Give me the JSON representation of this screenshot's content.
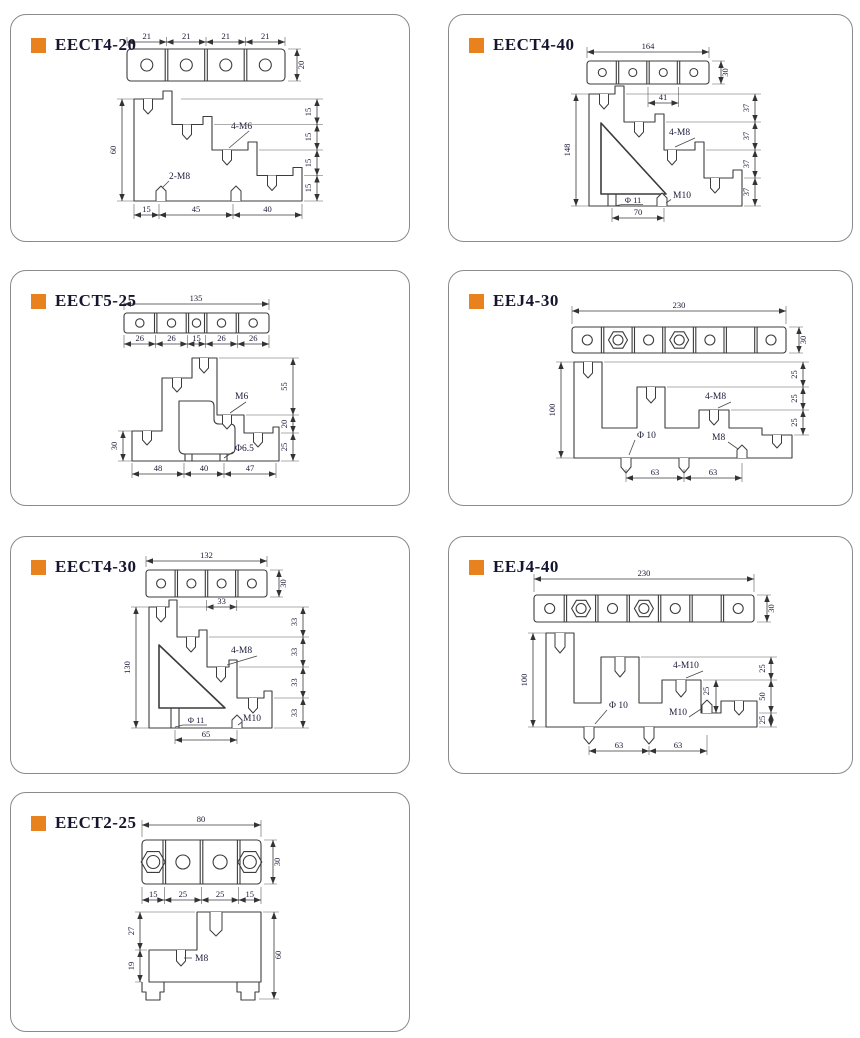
{
  "page": {
    "background": "#ffffff",
    "accent": "#e8821e"
  },
  "panels": [
    {
      "id": "eect4-20",
      "title": "EECT4-20",
      "top": {
        "dims_above": [
          "21",
          "21",
          "21",
          "21"
        ],
        "dim_right": "20"
      },
      "profile": {
        "dim_left": "60",
        "dims_right": [
          "15",
          "15",
          "15",
          "15"
        ],
        "dims_bottom": [
          "15",
          "45",
          "40"
        ],
        "label_studs": "4-M6",
        "label_bolts": "2-M8"
      }
    },
    {
      "id": "eect4-40",
      "title": "EECT4-40",
      "top": {
        "dim_above": "164",
        "dim_right": "30",
        "dim_below": "41"
      },
      "profile": {
        "dim_left": "148",
        "dims_right": [
          "37",
          "37",
          "37",
          "37"
        ],
        "dim_bottom": "70",
        "label_studs": "4-M8",
        "label_hole": "Φ 11",
        "label_bolt": "M10"
      }
    },
    {
      "id": "eect5-25",
      "title": "EECT5-25",
      "top": {
        "dim_above": "135",
        "dims_below": [
          "26",
          "26",
          "15",
          "26",
          "26"
        ]
      },
      "profile": {
        "dim_left": "30",
        "dims_right": [
          "55",
          "20",
          "25"
        ],
        "dims_bottom": [
          "48",
          "40",
          "47"
        ],
        "label_studs": "M6",
        "label_hole": "Φ6.5"
      }
    },
    {
      "id": "eej4-30",
      "title": "EEJ4-30",
      "top": {
        "dim_above": "230",
        "dim_right": "30"
      },
      "profile": {
        "dim_left": "100",
        "dims_right": [
          "25",
          "25",
          "25"
        ],
        "dims_bottom": [
          "63",
          "63"
        ],
        "label_studs": "4-M8",
        "label_hole": "Φ 10",
        "label_bolt": "M8"
      }
    },
    {
      "id": "eect4-30",
      "title": "EECT4-30",
      "top": {
        "dim_above": "132",
        "dim_right": "30",
        "dim_below": "33"
      },
      "profile": {
        "dim_left": "130",
        "dims_right": [
          "33",
          "33",
          "33",
          "33"
        ],
        "dim_bottom": "65",
        "label_studs": "4-M8",
        "label_hole": "Φ 11",
        "label_bolt": "M10"
      }
    },
    {
      "id": "eej4-40",
      "title": "EEJ4-40",
      "top": {
        "dim_above": "230",
        "dim_right": "30"
      },
      "profile": {
        "dim_left": "100",
        "dims_right": [
          "25",
          "50",
          "25"
        ],
        "dims_bottom": [
          "63",
          "63"
        ],
        "dim_inner": "25",
        "label_studs": "4-M10",
        "label_hole": "Φ 10",
        "label_bolt": "M10"
      }
    },
    {
      "id": "eect2-25",
      "title": "EECT2-25",
      "top": {
        "dim_above": "80",
        "dim_right": "30",
        "dims_below": [
          "15",
          "25",
          "25",
          "15"
        ]
      },
      "profile": {
        "dims_left": [
          "27",
          "19"
        ],
        "dim_right": "60",
        "label_bolt": "M8"
      }
    }
  ]
}
